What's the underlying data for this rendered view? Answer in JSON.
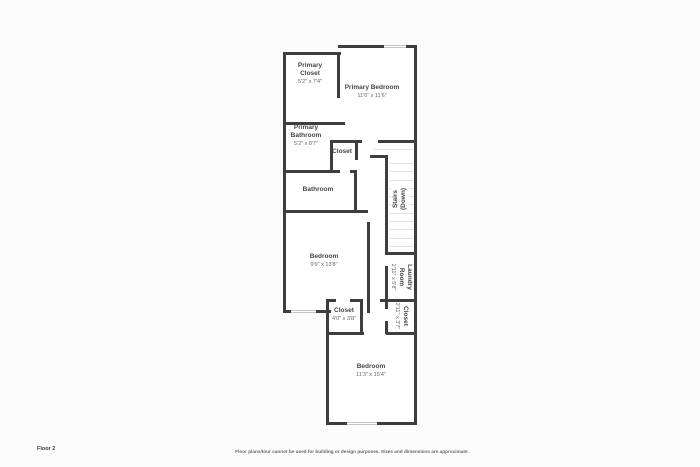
{
  "colors": {
    "bg": "#fcfcfc",
    "wall": "#3e3e3e",
    "window": "#c6c6c6",
    "step": "#e2e2e2",
    "label": "#454545",
    "dims": "#666666",
    "footer": "#3c3c3c"
  },
  "floor_plan": {
    "rooms": [
      {
        "id": "primary-closet",
        "name": "Primary Closet",
        "dims": "5'2\" x 7'4\""
      },
      {
        "id": "primary-bedroom",
        "name": "Primary Bedroom",
        "dims": "11'6\" x 11'6\""
      },
      {
        "id": "primary-bathroom",
        "name": "Primary Bathroom",
        "dims": "5'2\" x 8'7\""
      },
      {
        "id": "closet-upper",
        "name": "Closet"
      },
      {
        "id": "bathroom",
        "name": "Bathroom"
      },
      {
        "id": "stairs",
        "name": "Stairs",
        "sub": "(Down)"
      },
      {
        "id": "bedroom-middle",
        "name": "Bedroom",
        "dims": "9'9\" x 13'8\""
      },
      {
        "id": "laundry-room",
        "name": "Laundry Room",
        "dims": "2'11\" x 5'8\""
      },
      {
        "id": "closet-hall",
        "name": "Closet",
        "dims": "2'11\" x 3'7\""
      },
      {
        "id": "closet-center",
        "name": "Closet",
        "dims": "4'0\" x 3'8\""
      },
      {
        "id": "bedroom-lower",
        "name": "Bedroom",
        "dims": "11'3\" x 15'4\""
      }
    ]
  },
  "footer": {
    "floor_label": "Floor 2",
    "disclaimer": "Floor plans/tour cannot be used for building or design purposes. Sizes and dimensions are approximate."
  }
}
